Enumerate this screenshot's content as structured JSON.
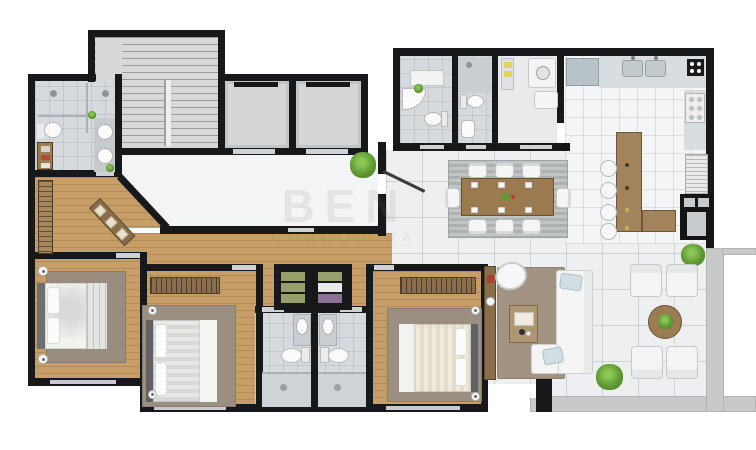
{
  "watermark": {
    "line1": "BEN",
    "line2": "CORRETORA"
  },
  "palette": {
    "wall": "#17181a",
    "wood_floor": "#c79e68",
    "wood_furniture": "#8a6d4b",
    "hall_tile": "#f3f4f5",
    "marble_tile": "#edeff0",
    "bath_tile": "#d7dadd",
    "kitchen_tile": "#f3f5f6",
    "concrete": "#c7cac8",
    "rug_dining": "#b6b9ba",
    "rug_living": "#a29382",
    "rug_bedroom": "#998d7e",
    "sofa_white": "#f4f5f4",
    "pillow_blue": "#cfdfe3",
    "plant_green": "#5f9a33",
    "island_wood": "#a3835c",
    "shelf_green": "#97a06b",
    "shelf_purple": "#8b6f94",
    "accent_red": "#b23b33"
  },
  "rooms": [
    {
      "id": "staircase"
    },
    {
      "id": "elevator-1"
    },
    {
      "id": "elevator-2"
    },
    {
      "id": "common-hall"
    },
    {
      "id": "master-bathroom"
    },
    {
      "id": "entry-hallway"
    },
    {
      "id": "bedroom-1"
    },
    {
      "id": "bedroom-2"
    },
    {
      "id": "bedroom-3"
    },
    {
      "id": "bathroom-left"
    },
    {
      "id": "bathroom-right"
    },
    {
      "id": "powder-room"
    },
    {
      "id": "service-bathroom"
    },
    {
      "id": "laundry"
    },
    {
      "id": "kitchen"
    },
    {
      "id": "dining-room"
    },
    {
      "id": "living-room"
    },
    {
      "id": "terrace"
    }
  ]
}
